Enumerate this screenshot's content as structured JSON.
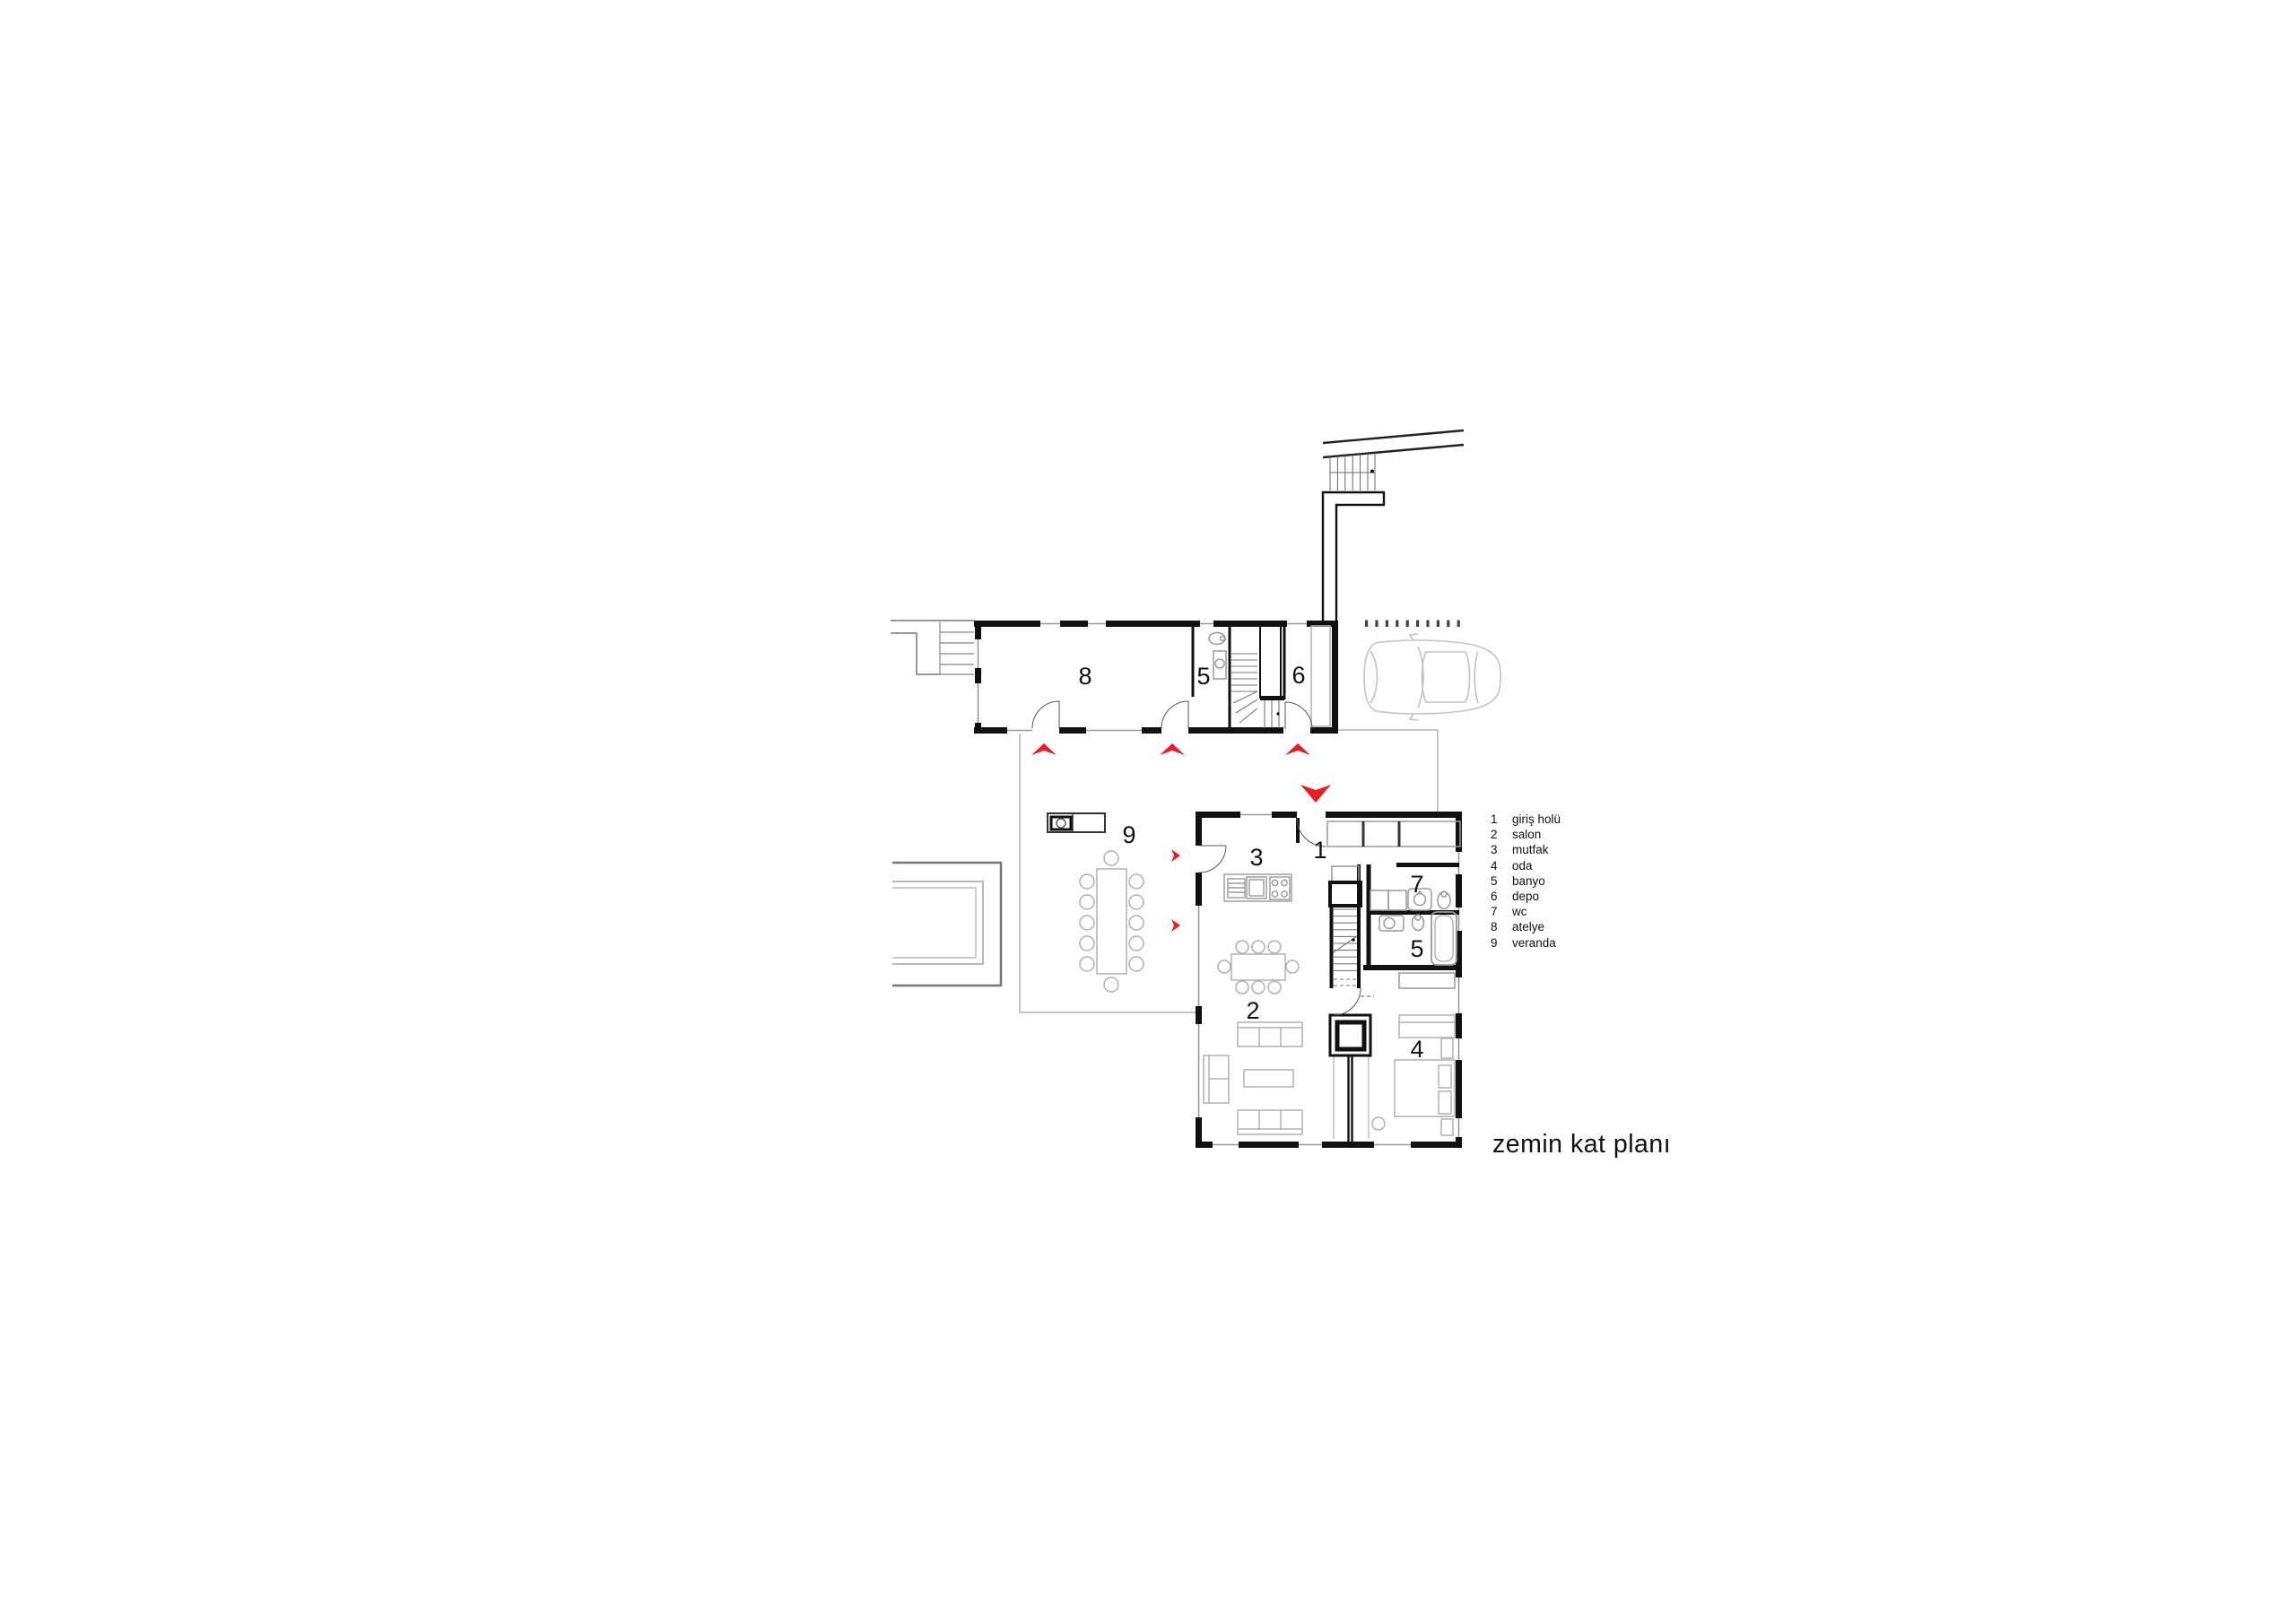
{
  "title": "zemin kat planı",
  "legend": {
    "items": [
      {
        "number": "1",
        "label": "giriş holü"
      },
      {
        "number": "2",
        "label": "salon"
      },
      {
        "number": "3",
        "label": "mutfak"
      },
      {
        "number": "4",
        "label": "oda"
      },
      {
        "number": "5",
        "label": "banyo"
      },
      {
        "number": "6",
        "label": "depo"
      },
      {
        "number": "7",
        "label": "wc"
      },
      {
        "number": "8",
        "label": "atelye"
      },
      {
        "number": "9",
        "label": "veranda"
      }
    ]
  },
  "floor_plan": {
    "upper_wing": {
      "atelye": "8",
      "banyo": "5",
      "depo": "6"
    },
    "main_house": {
      "giris_holu": "1",
      "salon": "2",
      "mutfak": "3",
      "oda": "4",
      "banyo": "5",
      "wc": "7"
    },
    "site": {
      "veranda": "9"
    },
    "colors": {
      "accent_red": "#ed1c24",
      "wall": "#111111",
      "furniture": "#b0b0b0",
      "site_line": "#b3b3b3"
    }
  }
}
